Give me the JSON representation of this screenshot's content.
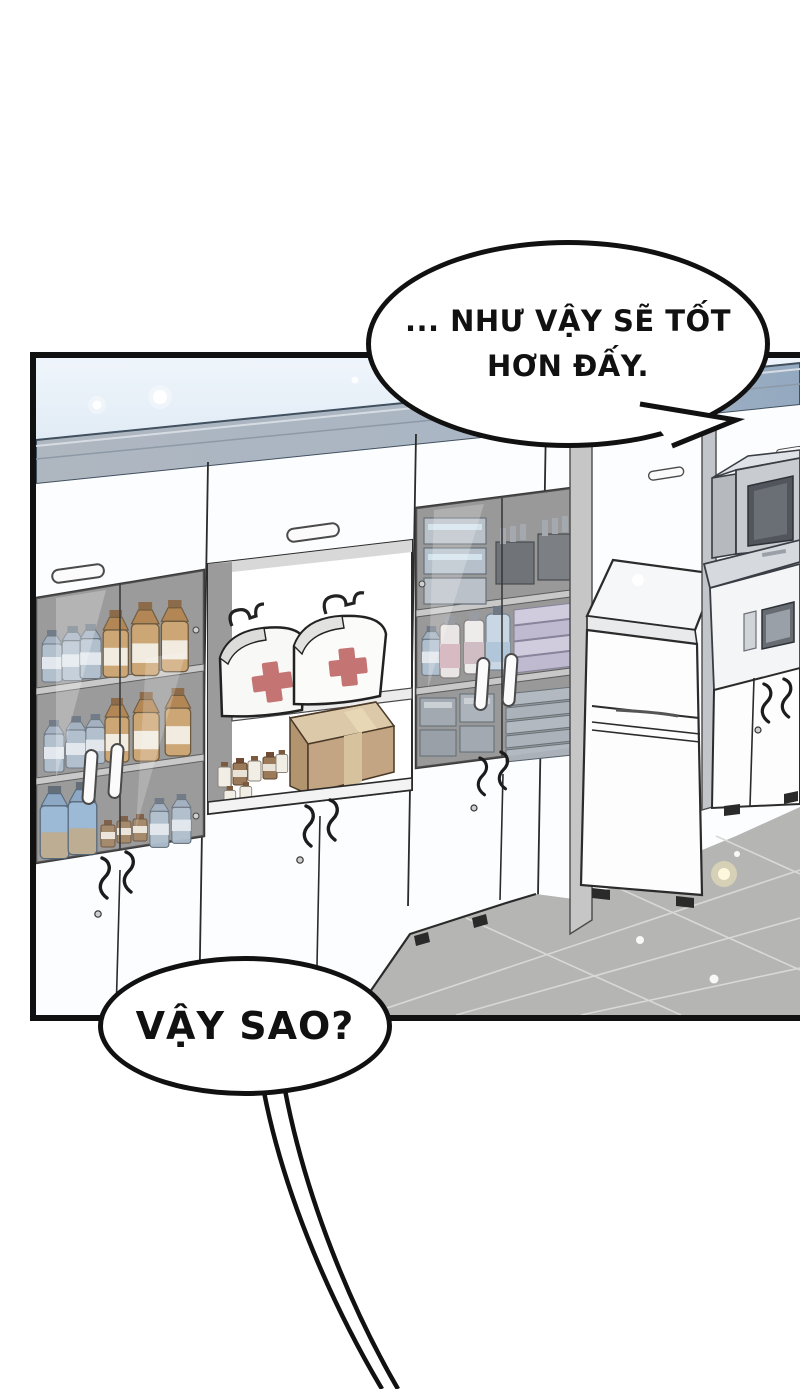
{
  "bubbles": {
    "top": {
      "line1": "... NHƯ VẬY SẼ TỐT",
      "line2": "HƠN ĐẤY."
    },
    "bottom": {
      "text": "VẬY SAO?"
    }
  },
  "palette": {
    "panel_border": "#111111",
    "wall_blue_top": "#eff5fb",
    "wall_blue": "#bed3e7",
    "cabinet_top_band": "#a9b6c4",
    "cabinet_white": "#fcfdfe",
    "glass_interior": "#8e8e8e",
    "amber_bottle": "#c59a62",
    "blue_bottle": "#8fb0d0",
    "first_aid_cross": "#c47473",
    "cardboard_box": "#c3a483",
    "floor_tile": "#b5b5b3",
    "appliance_gray": "#c8cbd0"
  }
}
